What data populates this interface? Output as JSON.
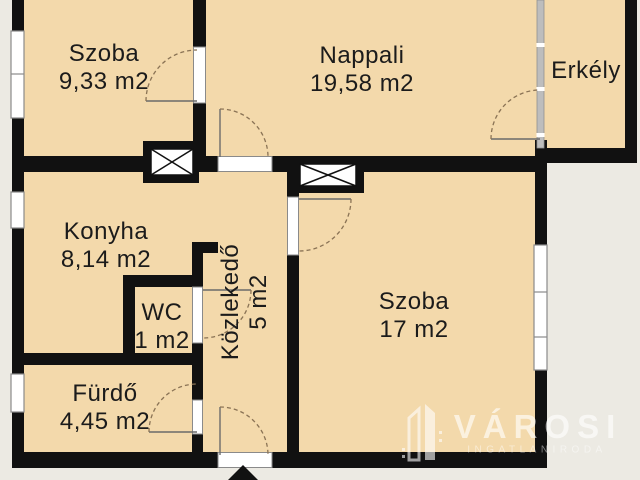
{
  "plan": {
    "rooms": [
      {
        "id": "szoba1",
        "name": "Szoba",
        "area": "9,33 m2"
      },
      {
        "id": "nappali",
        "name": "Nappali",
        "area": "19,58 m2"
      },
      {
        "id": "erkely",
        "name": "Erkély",
        "area": ""
      },
      {
        "id": "konyha",
        "name": "Konyha",
        "area": "8,14 m2"
      },
      {
        "id": "wc",
        "name": "WC",
        "area": "1 m2"
      },
      {
        "id": "kozlekedo",
        "name": "Közlekedő",
        "area": "5 m2"
      },
      {
        "id": "szoba2",
        "name": "Szoba",
        "area": "17 m2"
      },
      {
        "id": "furdo",
        "name": "Fürdő",
        "area": "4,45 m2"
      }
    ]
  },
  "watermark": {
    "brand": "VÁROSI",
    "subtitle": "INGATLANIRODA"
  },
  "colors": {
    "background": "#eceae3",
    "floor": "#f3d9ab",
    "wall": "#111111",
    "window_frame": "#8a8a8a",
    "window_fill": "#ffffff",
    "balcony_glazing": "#bdbdbd",
    "door_arc": "#8a7355",
    "label_text": "#1b1b1b",
    "watermark_white": "#ffffff"
  }
}
